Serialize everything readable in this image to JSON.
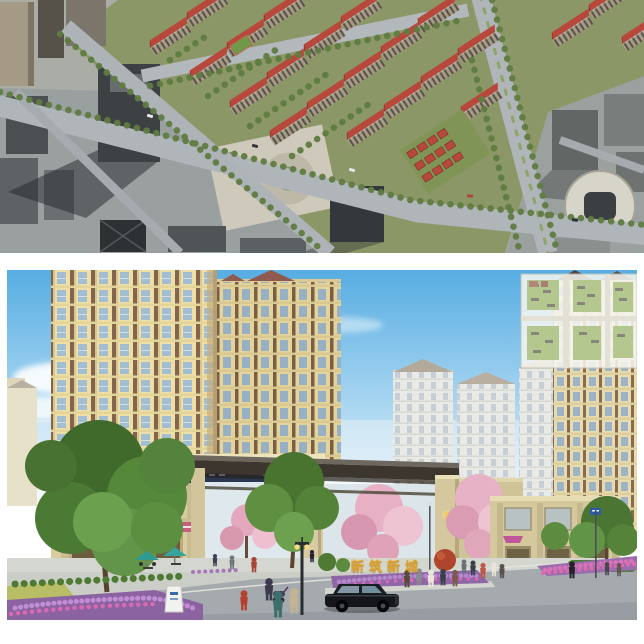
{
  "canvas": {
    "background": "#ffffff"
  },
  "street_sign": {
    "text": "新筑新城"
  },
  "colors": {
    "sign-gold": "#dfa32d",
    "sky-top": "#57ade2",
    "sky-horizon": "#dceef8",
    "roof-red": "#b8483c",
    "facade-cream": "#eddfa6",
    "canopy-dark": "#3c362e",
    "flower-purple": "#9468a8",
    "flower-magenta": "#d86ab4"
  }
}
